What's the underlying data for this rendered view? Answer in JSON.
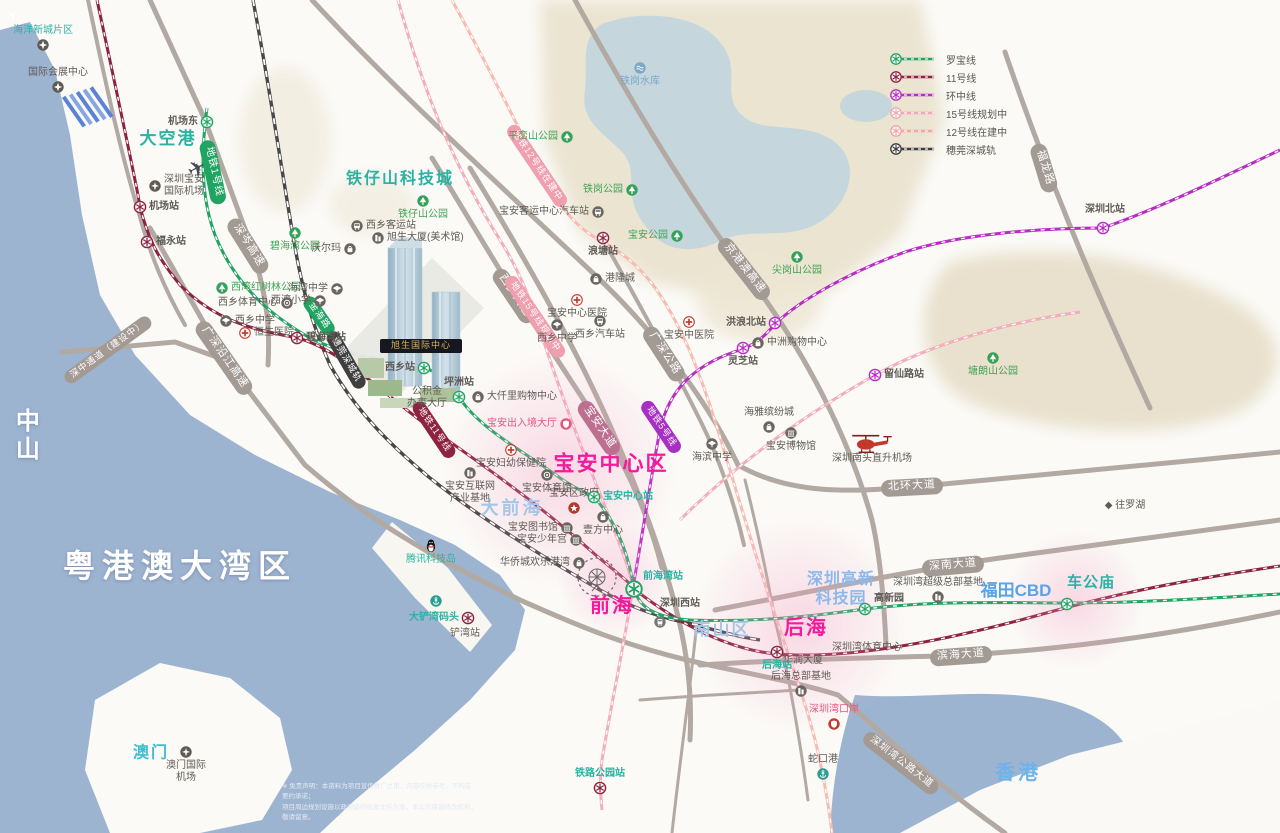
{
  "legend": {
    "items": [
      {
        "label": "罗宝线",
        "color": "#1fa462"
      },
      {
        "label": "11号线",
        "color": "#8d2340"
      },
      {
        "label": "环中线",
        "color": "#b82cc4"
      },
      {
        "label": "15号线规划中",
        "color": "#f0a8b4"
      },
      {
        "label": "12号线在建中",
        "color": "#f2a5a0"
      },
      {
        "label": "穗莞深城轨",
        "color": "#3c3c3c"
      }
    ]
  },
  "building": {
    "label": "旭生国际中心"
  },
  "disclaimer": {
    "l1": "※ 免责声明：本资料为项目宣传推广之用，内容仅供参考，不构成要约承诺；",
    "l2": "项目周边规划设施以政府最终批复文件为准，本公司保留修改权利，敬请留意。"
  },
  "areas": [
    {
      "t": "粤港澳大湾区",
      "x": 180,
      "y": 566,
      "fs": 32,
      "c": "#ffffff",
      "b": 1,
      "ls": 7,
      "sh": 1
    },
    {
      "t": "中山",
      "x": 24,
      "y": 436,
      "fs": 24,
      "c": "#ffffff",
      "b": 1,
      "vert": 1,
      "sh": 1
    },
    {
      "t": "大空港",
      "x": 168,
      "y": 139,
      "fs": 17,
      "c": "#2ab3a3",
      "b": 1,
      "ls": 2
    },
    {
      "t": "铁仔山科技城",
      "x": 400,
      "y": 179,
      "fs": 16,
      "c": "#2ab3a3",
      "b": 1,
      "ls": 2
    },
    {
      "t": "大前海",
      "x": 512,
      "y": 509,
      "fs": 18,
      "c": "#a6c6e8",
      "b": 1,
      "ls": 3
    },
    {
      "t": "宝安中心区",
      "x": 611,
      "y": 464,
      "fs": 21,
      "c": "#f5199b",
      "b": 1,
      "ls": 2
    },
    {
      "t": "前海",
      "x": 612,
      "y": 606,
      "fs": 20,
      "c": "#f5199b",
      "b": 1,
      "ls": 2
    },
    {
      "t": "后海",
      "x": 806,
      "y": 628,
      "fs": 20,
      "c": "#f5199b",
      "b": 1,
      "ls": 2
    },
    {
      "t": "南山区",
      "x": 722,
      "y": 630,
      "fs": 17,
      "c": "#a6c6e8",
      "b": 1,
      "ls": 2
    },
    {
      "t": "深圳高新\n科技园",
      "x": 841,
      "y": 589,
      "fs": 16,
      "c": "#8ab9ea",
      "b": 1,
      "ls": 1
    },
    {
      "t": "福田CBD",
      "x": 1016,
      "y": 591,
      "fs": 17,
      "c": "#5ba3e8",
      "b": 1
    },
    {
      "t": "香港",
      "x": 1018,
      "y": 773,
      "fs": 20,
      "c": "#6fb3e8",
      "b": 1,
      "ls": 3
    },
    {
      "t": "澳门",
      "x": 151,
      "y": 753,
      "fs": 16,
      "c": "#3fbdd1",
      "b": 1,
      "ls": 2
    },
    {
      "t": "◆ 往罗湖",
      "x": 1125,
      "y": 506,
      "fs": 10,
      "c": "#5f5a55"
    }
  ],
  "pills": [
    {
      "t": "地铁1号线",
      "x": 213,
      "y": 172,
      "r": 78,
      "bg": "#1fa462",
      "fs": 10
    },
    {
      "t": "深岑高速",
      "x": 248,
      "y": 246,
      "r": 58,
      "bg": "#a39a93"
    },
    {
      "t": "广深沿江高速",
      "x": 224,
      "y": 358,
      "r": 55,
      "bg": "#a39a93"
    },
    {
      "t": "深中通道（建设中）",
      "x": 108,
      "y": 350,
      "r": -36,
      "bg": "#a39a93",
      "fs": 9
    },
    {
      "t": "穗莞深城轨",
      "x": 346,
      "y": 360,
      "r": 60,
      "bg": "#3f3f3f",
      "fs": 9
    },
    {
      "t": "金海路",
      "x": 319,
      "y": 316,
      "r": 55,
      "bg": "#1fa462",
      "fs": 9
    },
    {
      "t": "西乡大道",
      "x": 514,
      "y": 296,
      "r": 56,
      "bg": "#a39a93"
    },
    {
      "t": "地铁15号线规划中",
      "x": 535,
      "y": 317,
      "r": 56,
      "bg": "#ef9fae",
      "fs": 9
    },
    {
      "t": "地铁12号线在建中",
      "x": 537,
      "y": 166,
      "r": 56,
      "bg": "#ef9fae",
      "fs": 9
    },
    {
      "t": "广深公路",
      "x": 664,
      "y": 354,
      "r": 57,
      "bg": "#a39a93"
    },
    {
      "t": "宝安大道",
      "x": 599,
      "y": 428,
      "r": 56,
      "bg": "#bc6f8f"
    },
    {
      "t": "地铁5号线",
      "x": 661,
      "y": 427,
      "r": 56,
      "bg": "#a82fc4",
      "fs": 9
    },
    {
      "t": "地铁11号线",
      "x": 434,
      "y": 430,
      "r": 56,
      "bg": "#8d2340",
      "fs": 9
    },
    {
      "t": "京港澳高速",
      "x": 744,
      "y": 269,
      "r": 52,
      "bg": "#a39a93"
    },
    {
      "t": "北环大道",
      "x": 912,
      "y": 487,
      "r": -3,
      "bg": "#a39a93"
    },
    {
      "t": "深南大道",
      "x": 953,
      "y": 566,
      "r": -5,
      "bg": "#a39a93"
    },
    {
      "t": "滨海大道",
      "x": 961,
      "y": 656,
      "r": -4,
      "bg": "#a39a93"
    },
    {
      "t": "深圳湾公路大道",
      "x": 901,
      "y": 763,
      "r": 38,
      "bg": "#a39a93",
      "fs": 10
    },
    {
      "t": "福龙路",
      "x": 1044,
      "y": 168,
      "r": 73,
      "bg": "#a39a93"
    }
  ],
  "stations": [
    {
      "n": "机场东",
      "x": 207,
      "y": 122,
      "c": "green",
      "lp": "l",
      "lc": "dark"
    },
    {
      "n": "机场站",
      "x": 140,
      "y": 207,
      "c": "maroon",
      "lp": "r",
      "lc": "dark"
    },
    {
      "n": "福永站",
      "x": 147,
      "y": 242,
      "c": "maroon",
      "lp": "r",
      "lc": "dark"
    },
    {
      "n": "碧海湾站",
      "x": 297,
      "y": 338,
      "c": "maroon",
      "lp": "r",
      "lc": "dark"
    },
    {
      "n": "西乡站",
      "x": 424,
      "y": 368,
      "c": "green",
      "lp": "l",
      "lc": "dark"
    },
    {
      "n": "坪洲站",
      "x": 459,
      "y": 397,
      "c": "green",
      "lp": "t",
      "lc": "dark"
    },
    {
      "n": "宝安中心站",
      "x": 594,
      "y": 497,
      "c": "green",
      "lp": "r",
      "lc": "teal"
    },
    {
      "n": "前海湾站",
      "x": 634,
      "y": 589,
      "c": "green",
      "big": 1,
      "lp": "r",
      "dy": -12,
      "lc": "teal"
    },
    {
      "n": "高新园",
      "x": 865,
      "y": 609,
      "c": "green",
      "lp": "r",
      "dy": -10,
      "lc": "dark"
    },
    {
      "n": "车公庙",
      "x": 1067,
      "y": 604,
      "c": "green",
      "lp": "t",
      "dy": -4,
      "lc": "tealBig"
    },
    {
      "n": "浪塘站",
      "x": 603,
      "y": 238,
      "c": "maroon",
      "lp": "b",
      "lc": "dark"
    },
    {
      "n": "灵芝站",
      "x": 743,
      "y": 348,
      "c": "magenta",
      "lp": "b",
      "lc": "dark"
    },
    {
      "n": "洪浪北站",
      "x": 775,
      "y": 323,
      "c": "magenta",
      "lp": "l",
      "lc": "dark"
    },
    {
      "n": "留仙路站",
      "x": 875,
      "y": 375,
      "c": "magenta",
      "lp": "r",
      "lc": "dark"
    },
    {
      "n": "深圳北站",
      "x": 1103,
      "y": 228,
      "c": "magenta",
      "lp": "t",
      "dx": -18,
      "dy": -4,
      "lc": "dark"
    },
    {
      "n": "大铲湾码头",
      "x": 468,
      "y": 618,
      "c": "maroon",
      "lp": "l",
      "lc": "teal"
    },
    {
      "n": "铁路公园站",
      "x": 600,
      "y": 788,
      "c": "maroon",
      "lp": "t",
      "lc": "teal"
    },
    {
      "n": "后海站",
      "x": 777,
      "y": 652,
      "c": "maroon",
      "lp": "b",
      "lc": "teal"
    },
    {
      "n": "深圳西站",
      "x": 660,
      "y": 622,
      "c": "train",
      "lp": "t",
      "dy": -4,
      "lc": "dark"
    }
  ],
  "pois": [
    {
      "n": "海洋新城片区",
      "x": 43,
      "y": 45,
      "icon": "star",
      "lp": "t",
      "lc": "teal"
    },
    {
      "n": "国际会展中心",
      "x": 58,
      "y": 87,
      "icon": "star",
      "lp": "t",
      "lc": "dark"
    },
    {
      "n": "深圳宝安\n国际机场",
      "x": 155,
      "y": 186,
      "icon": "plane-circle",
      "lp": "r",
      "lc": "dark"
    },
    {
      "n": "",
      "x": 197,
      "y": 169,
      "icon": "plane-big",
      "lp": "c",
      "lc": "dark"
    },
    {
      "n": "",
      "x": 12,
      "y": 16,
      "icon": "plane-small",
      "lp": "c",
      "lc": "dark"
    },
    {
      "n": "铁仔山公园",
      "x": 423,
      "y": 201,
      "icon": "tree",
      "lp": "b",
      "lc": "green"
    },
    {
      "n": "平峦山公园",
      "x": 567,
      "y": 137,
      "icon": "tree",
      "lp": "l",
      "lc": "green"
    },
    {
      "n": "铁岗公园",
      "x": 632,
      "y": 190,
      "icon": "tree",
      "lp": "l",
      "lc": "green"
    },
    {
      "n": "宝安公园",
      "x": 677,
      "y": 236,
      "icon": "tree",
      "lp": "l",
      "lc": "green"
    },
    {
      "n": "尖岗山公园",
      "x": 797,
      "y": 257,
      "icon": "tree",
      "lp": "b",
      "lc": "green"
    },
    {
      "n": "塘朗山公园",
      "x": 993,
      "y": 358,
      "icon": "tree",
      "lp": "b",
      "lc": "green"
    },
    {
      "n": "铁岗水库",
      "x": 640,
      "y": 68,
      "icon": "reservoir",
      "lp": "b",
      "lc": "blue"
    },
    {
      "n": "宝安客运中心汽车站",
      "x": 598,
      "y": 212,
      "icon": "bus",
      "lp": "l",
      "lc": "dark"
    },
    {
      "n": "西乡客运站",
      "x": 357,
      "y": 226,
      "icon": "bus",
      "lp": "r",
      "lc": "dark"
    },
    {
      "n": "旭生大厦(美术馆)",
      "x": 378,
      "y": 238,
      "icon": "building",
      "lp": "r",
      "lc": "dark"
    },
    {
      "n": "碧海湾公园",
      "x": 295,
      "y": 233,
      "icon": "tree",
      "lp": "b",
      "lc": "green"
    },
    {
      "n": "沃尔玛",
      "x": 350,
      "y": 249,
      "icon": "shopping",
      "lp": "l",
      "lc": "dark"
    },
    {
      "n": "西湾红树林公园",
      "x": 222,
      "y": 288,
      "icon": "tree",
      "lp": "r",
      "lc": "green"
    },
    {
      "n": "海湾中学",
      "x": 337,
      "y": 289,
      "icon": "school",
      "lp": "l",
      "lc": "dark"
    },
    {
      "n": "西湾小学",
      "x": 320,
      "y": 301,
      "icon": "school",
      "lp": "l",
      "lc": "dark"
    },
    {
      "n": "西乡体育中心",
      "x": 287,
      "y": 303,
      "icon": "gym",
      "lp": "l",
      "lc": "dark"
    },
    {
      "n": "西乡中学",
      "x": 226,
      "y": 321,
      "icon": "school",
      "lp": "r",
      "lc": "dark"
    },
    {
      "n": "恒生医院",
      "x": 245,
      "y": 333,
      "icon": "cross",
      "lp": "r",
      "lc": "dark"
    },
    {
      "n": "公积金\n办事大厅",
      "x": 427,
      "y": 398,
      "lp": "c",
      "lc": "dark"
    },
    {
      "n": "大仟里购物中心",
      "x": 478,
      "y": 397,
      "icon": "shopping",
      "lp": "r",
      "lc": "dark"
    },
    {
      "n": "宝安出入境大厅",
      "x": 566,
      "y": 424,
      "icon": "customs",
      "lp": "l",
      "lc": "pink"
    },
    {
      "n": "宝安妇幼保健院",
      "x": 511,
      "y": 450,
      "icon": "cross",
      "lp": "b",
      "lc": "dark"
    },
    {
      "n": "宝安体育馆",
      "x": 547,
      "y": 475,
      "icon": "gym",
      "lp": "b",
      "lc": "dark"
    },
    {
      "n": "宝安区政府",
      "x": 574,
      "y": 508,
      "icon": "gov",
      "lp": "t",
      "lc": "dark"
    },
    {
      "n": "宝安互联网\n产业基地",
      "x": 470,
      "y": 473,
      "icon": "building",
      "lp": "b",
      "lc": "dark"
    },
    {
      "n": "宝安图书馆",
      "x": 567,
      "y": 528,
      "icon": "museum",
      "lp": "l",
      "lc": "dark"
    },
    {
      "n": "宝安少年宫",
      "x": 576,
      "y": 540,
      "icon": "museum",
      "lp": "l",
      "lc": "dark"
    },
    {
      "n": "华侨城欢乐港湾",
      "x": 579,
      "y": 563,
      "icon": "shopping",
      "lp": "l",
      "lc": "dark"
    },
    {
      "n": "壹方中心",
      "x": 603,
      "y": 517,
      "icon": "shopping",
      "lp": "b",
      "lc": "dark"
    },
    {
      "n": "港隆城",
      "x": 596,
      "y": 279,
      "icon": "shopping",
      "lp": "r",
      "lc": "dark"
    },
    {
      "n": "宝安中心医院",
      "x": 577,
      "y": 300,
      "icon": "cross",
      "lp": "b",
      "lc": "dark"
    },
    {
      "n": "西乡中学",
      "x": 557,
      "y": 325,
      "icon": "school",
      "lp": "b",
      "lc": "dark"
    },
    {
      "n": "西乡汽车站",
      "x": 600,
      "y": 321,
      "icon": "bus",
      "lp": "b",
      "lc": "dark"
    },
    {
      "n": "宝安中医院",
      "x": 689,
      "y": 322,
      "icon": "cross",
      "lp": "b",
      "lc": "dark"
    },
    {
      "n": "中洲购物中心",
      "x": 758,
      "y": 343,
      "icon": "shopping",
      "lp": "r",
      "lc": "dark"
    },
    {
      "n": "海雅缤纷城",
      "x": 769,
      "y": 427,
      "icon": "shopping",
      "lp": "t",
      "lc": "dark"
    },
    {
      "n": "宝安博物馆",
      "x": 791,
      "y": 433,
      "icon": "museum",
      "lp": "b",
      "lc": "dark"
    },
    {
      "n": "海滨中学",
      "x": 712,
      "y": 444,
      "icon": "school",
      "lp": "b",
      "lc": "dark"
    },
    {
      "n": "深圳南头直升机场",
      "x": 872,
      "y": 445,
      "icon": "heli",
      "lp": "b",
      "lc": "dark"
    },
    {
      "n": "腾讯科技岛",
      "x": 431,
      "y": 546,
      "icon": "qq",
      "lp": "b",
      "lc": "teal"
    },
    {
      "n": "",
      "x": 436,
      "y": 601,
      "icon": "anchor",
      "lp": "c",
      "lc": "dark"
    },
    {
      "n": "铲湾站",
      "x": 465,
      "y": 634,
      "lp": "c",
      "lc": "dark"
    },
    {
      "n": "深圳湾体育中心",
      "x": 867,
      "y": 648,
      "lp": "c",
      "lc": "dark"
    },
    {
      "n": "华润大厦",
      "x": 803,
      "y": 661,
      "lp": "c",
      "lc": "dark"
    },
    {
      "n": "后海总部基地",
      "x": 801,
      "y": 691,
      "icon": "building",
      "lp": "t",
      "lc": "dark"
    },
    {
      "n": "深圳湾超级总部基地",
      "x": 938,
      "y": 597,
      "icon": "building",
      "lp": "t",
      "lc": "dark"
    },
    {
      "n": "深圳湾口岸",
      "x": 834,
      "y": 724,
      "icon": "customs-red",
      "lp": "t",
      "lc": "pink"
    },
    {
      "n": "蛇口港",
      "x": 823,
      "y": 774,
      "icon": "anchor",
      "lp": "t",
      "lc": "dark"
    },
    {
      "n": "澳门国际\n机场",
      "x": 186,
      "y": 752,
      "icon": "plane-circle",
      "lp": "b",
      "lc": "dark"
    }
  ]
}
